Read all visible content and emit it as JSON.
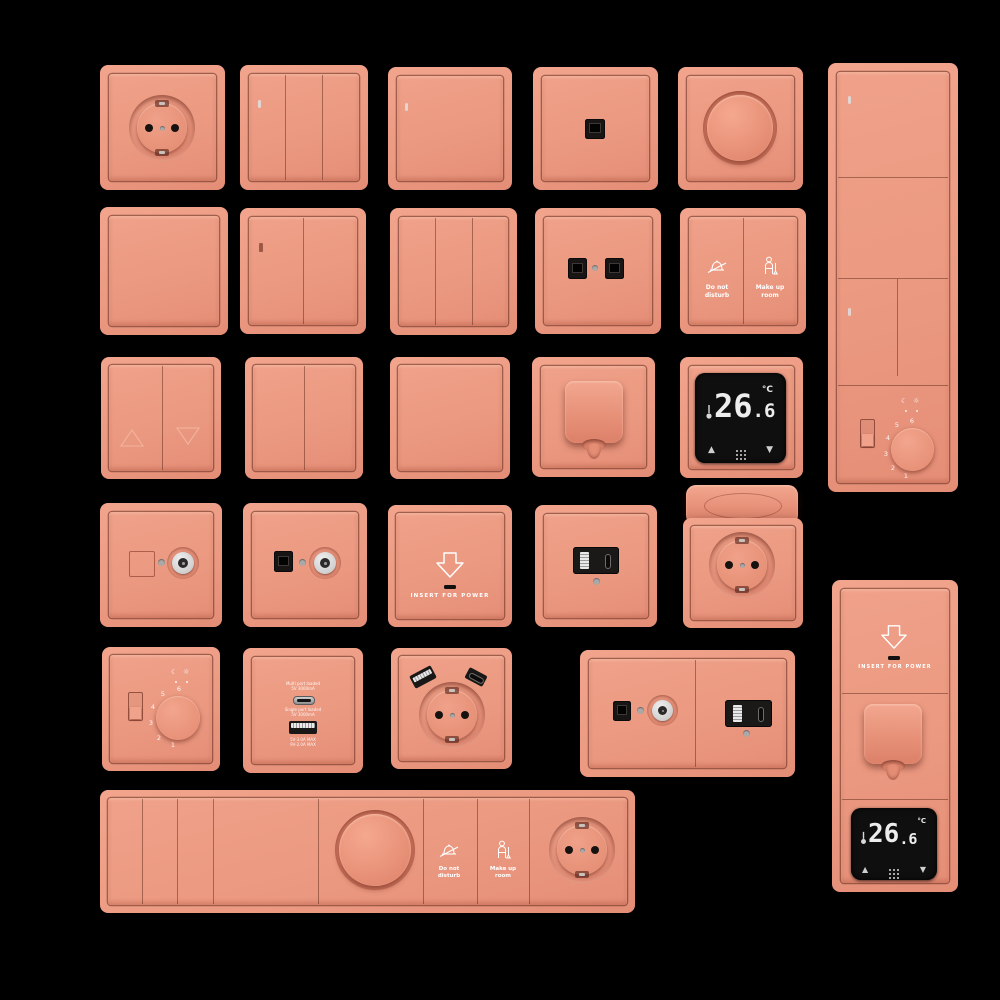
{
  "colors": {
    "background": "#000000",
    "plate": "#EC9A82",
    "plate_recess": "#D97F69",
    "module_black": "#1B1918",
    "display_black": "#0F0F0F",
    "digit_white": "#EDEDED",
    "metal_silver": "#D8D8D8",
    "indicator_gray": "#AAA9A8",
    "icon_white": "#FFFFFF"
  },
  "labels": {
    "do_not_disturb_line1": "Do not",
    "do_not_disturb_line2": "disturb",
    "make_up_room_line1": "Make up",
    "make_up_room_line2": "room",
    "insert_for_power": "INSERT FOR POWER"
  },
  "digital_thermostat": {
    "temp_integer": "26",
    "temp_fraction": ".6",
    "unit": "°C",
    "up_arrow": "▲",
    "down_arrow": "▼"
  },
  "analog_thermostat": {
    "dial_numbers": [
      "6",
      "5",
      "4",
      "3",
      "2",
      "1"
    ],
    "moon_icon": "☾",
    "sun_icon": "☼"
  },
  "usb_charger_plate": {
    "port_c_label_line1": "Multi port loaded",
    "port_c_label_line2": "5V 3000mA",
    "port_a_label_line1": "Single port loaded",
    "port_a_label_line2": "5V 3000mA",
    "bottom_label_line1": "5V-3.0A MAX",
    "bottom_label_line2": "9V-2.0A MAX"
  }
}
